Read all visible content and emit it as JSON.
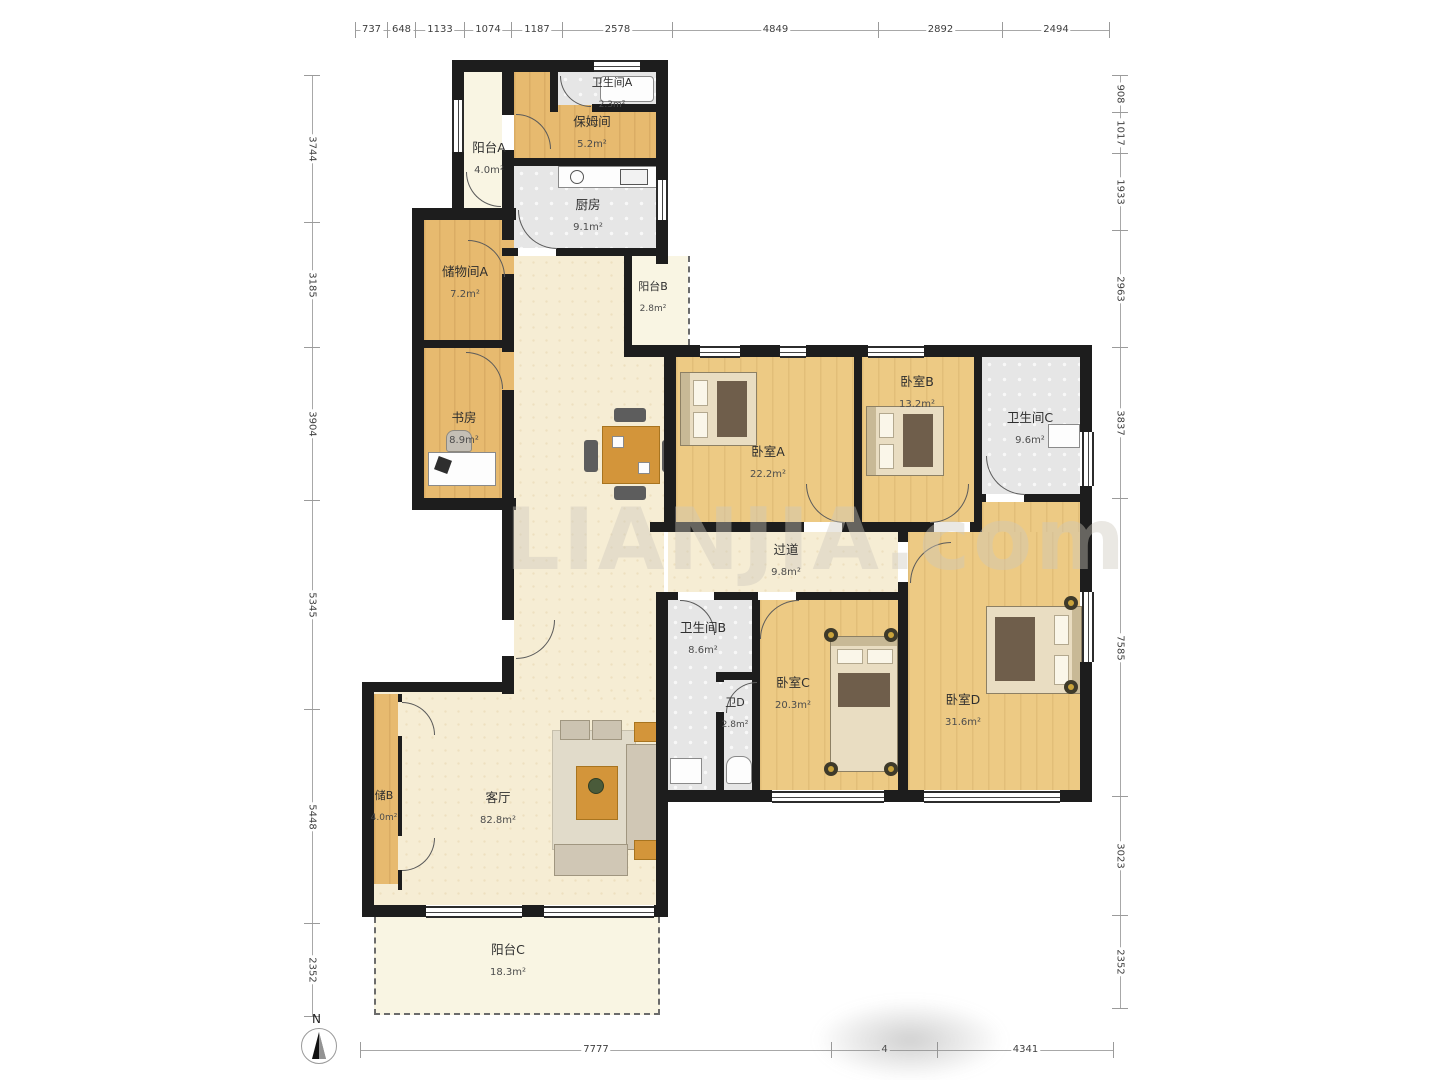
{
  "meta": {
    "watermark": "LIANJIA.com",
    "north_label": "N"
  },
  "rooms": [
    {
      "id": "yangtai-a",
      "name": "阳台A",
      "area": "4.0m²"
    },
    {
      "id": "weishengjian-a",
      "name": "卫生间A",
      "area": "2.3m²"
    },
    {
      "id": "baomujian",
      "name": "保姆间",
      "area": "5.2m²"
    },
    {
      "id": "chufang",
      "name": "厨房",
      "area": "9.1m²"
    },
    {
      "id": "chuwujian-a",
      "name": "储物间A",
      "area": "7.2m²"
    },
    {
      "id": "yangtai-b",
      "name": "阳台B",
      "area": "2.8m²"
    },
    {
      "id": "shufang",
      "name": "书房",
      "area": "8.9m²"
    },
    {
      "id": "woshi-a",
      "name": "卧室A",
      "area": "22.2m²"
    },
    {
      "id": "woshi-b",
      "name": "卧室B",
      "area": "13.2m²"
    },
    {
      "id": "weishengjian-c",
      "name": "卫生间C",
      "area": "9.6m²"
    },
    {
      "id": "guodao",
      "name": "过道",
      "area": "9.8m²"
    },
    {
      "id": "weishengjian-b",
      "name": "卫生间B",
      "area": "8.6m²"
    },
    {
      "id": "wei-d",
      "name": "卫D",
      "area": "2.8m²"
    },
    {
      "id": "woshi-c",
      "name": "卧室C",
      "area": "20.3m²"
    },
    {
      "id": "woshi-d",
      "name": "卧室D",
      "area": "31.6m²"
    },
    {
      "id": "chu-b",
      "name": "储B",
      "area": "4.0m²"
    },
    {
      "id": "keting",
      "name": "客厅",
      "area": "82.8m²"
    },
    {
      "id": "yangtai-c",
      "name": "阳台C",
      "area": "18.3m²"
    }
  ],
  "rulers": {
    "top": [
      "737",
      "648",
      "1133",
      "1074",
      "1187",
      "2578",
      "4849",
      "2892",
      "2494"
    ],
    "left": [
      "3744",
      "3185",
      "3904",
      "5345",
      "5448",
      "2352"
    ],
    "right": [
      "908",
      "1017",
      "1933",
      "2963",
      "3837",
      "7585",
      "3023",
      "2352"
    ],
    "bottom": [
      "7777",
      "4",
      "4341"
    ]
  }
}
